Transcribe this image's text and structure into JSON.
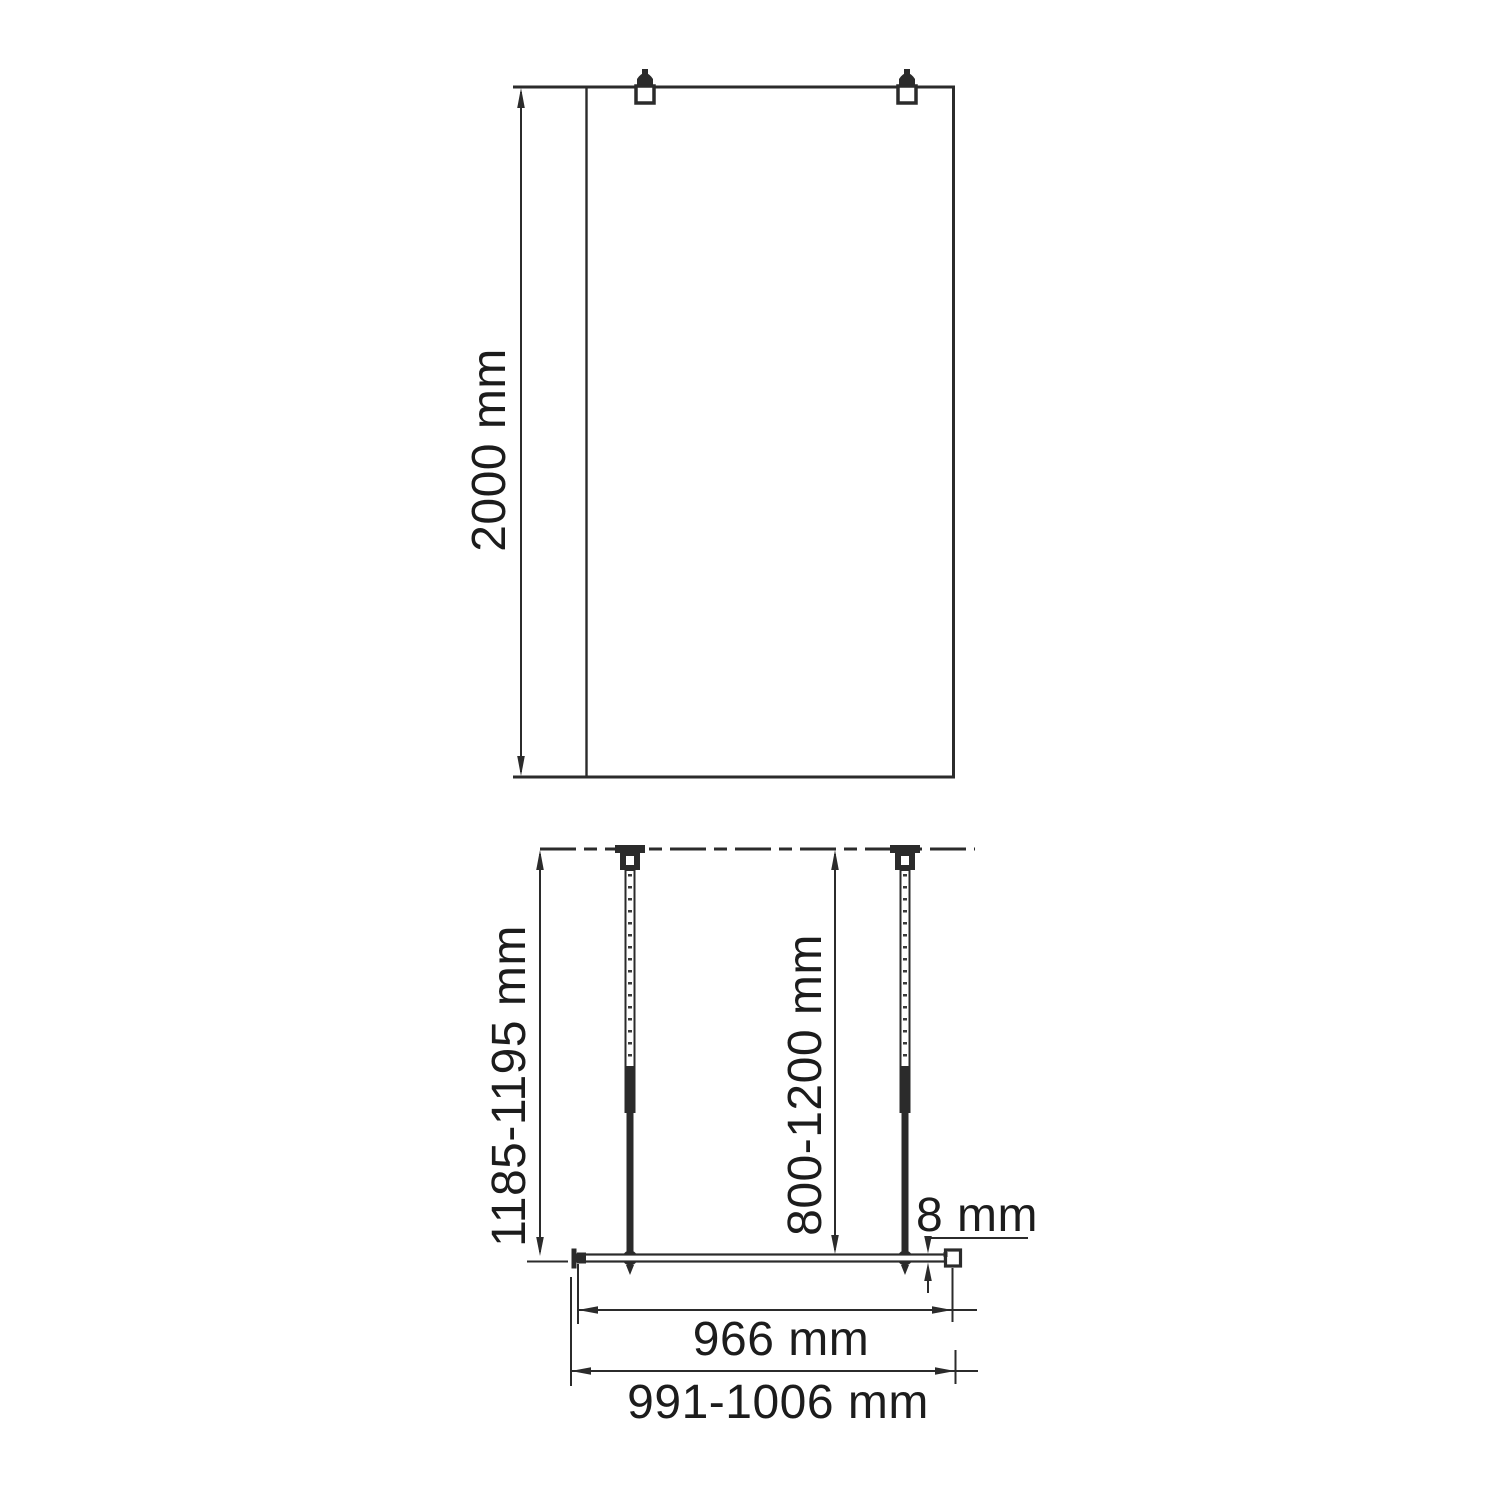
{
  "front_view": {
    "height_label": "2000 mm"
  },
  "plan_view": {
    "bar_length_label": "1185-1195 mm",
    "bar_mount_range_label": "800-1200 mm",
    "glass_thickness_label": "8 mm",
    "glass_width_label": "966 mm",
    "overall_width_label": "991-1006 mm"
  },
  "colors": {
    "line": "#2b2b2b",
    "text": "#1c1c1c",
    "background": "#ffffff"
  }
}
